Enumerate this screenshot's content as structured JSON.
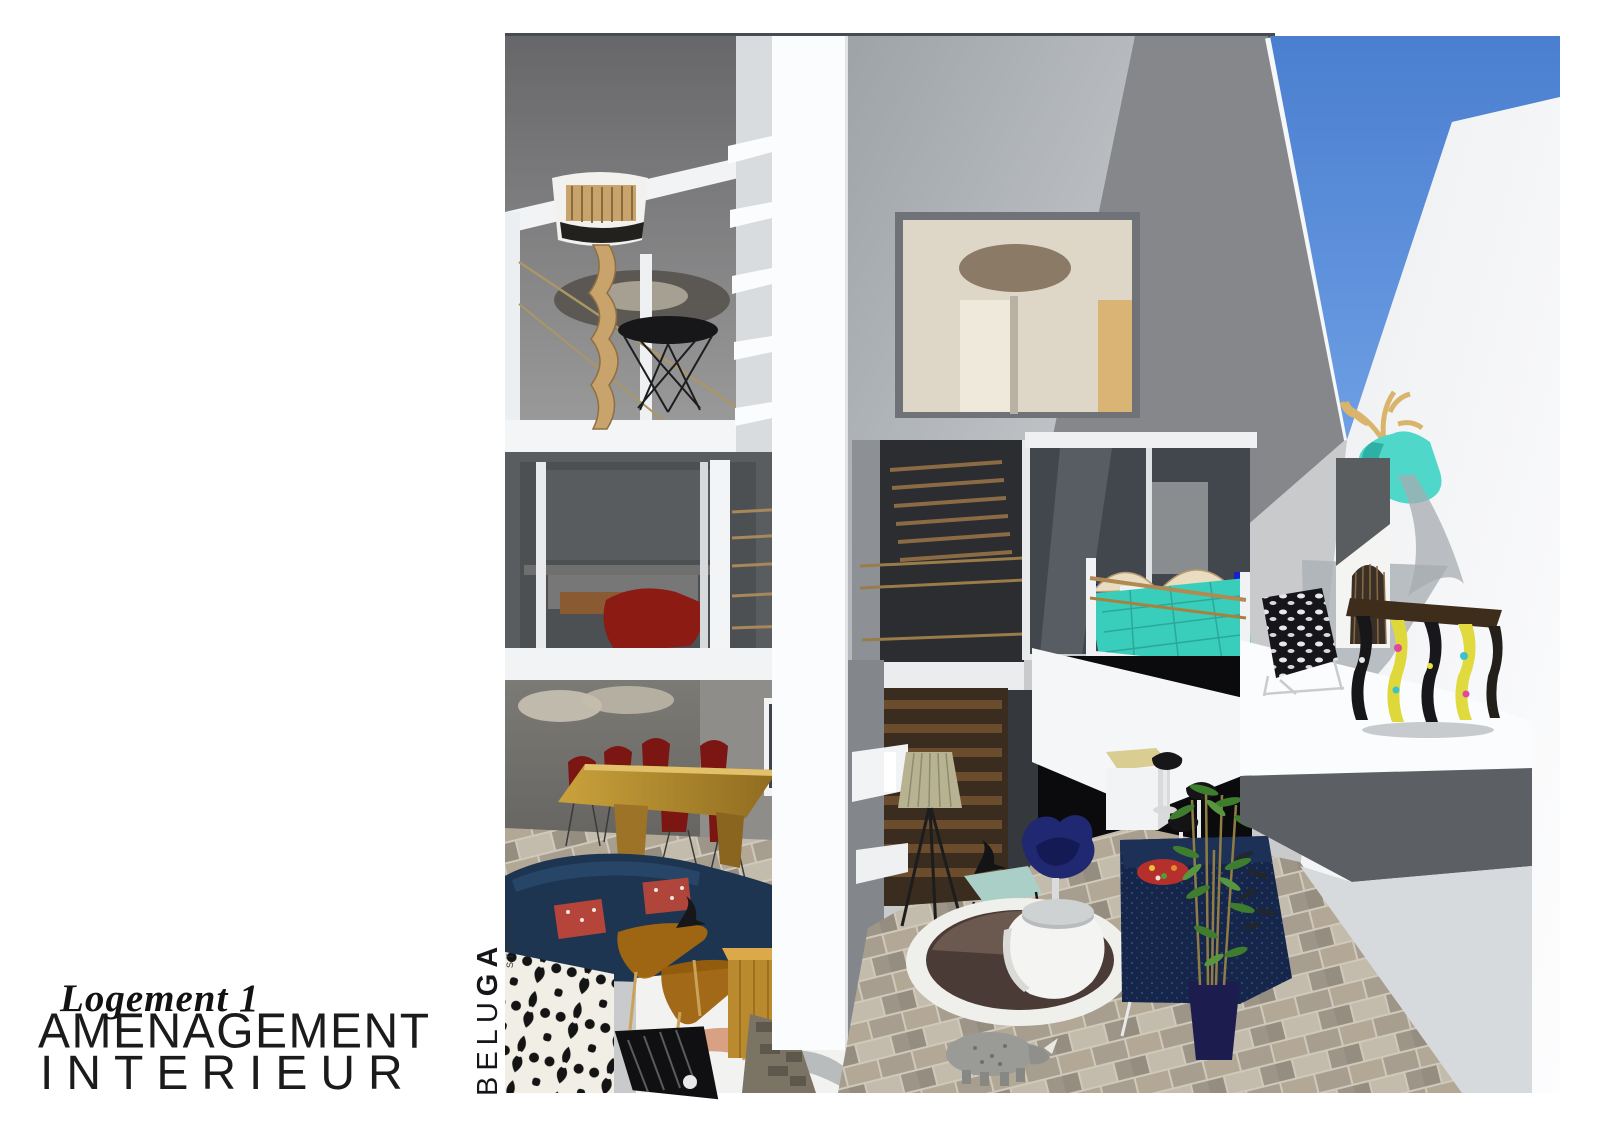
{
  "titles": {
    "project": "Logement 1",
    "subtitle_line1": "AMENAGEMENT",
    "subtitle_line2": "INTERIEUR"
  },
  "brand": {
    "name_light": "BELU",
    "name_bold": "GA",
    "tagline": "STUDIO"
  },
  "colors": {
    "sky": "#4e84d6",
    "roofGray": "#85878a",
    "ceilingGray": "#707071",
    "wallLight": "#c3c6c9",
    "wallWhite": "#f5f6f7",
    "glassDark": "#42474d",
    "stairWood": "#5b422c",
    "tableWood": "#b98a2e",
    "chairRed": "#8c1b13",
    "sofaNavy": "#1d3550",
    "benchNavy": "#16264a",
    "swanNavy": "#1f2870",
    "bedTeal": "#39cdbb",
    "deerTeal": "#4fd8ca",
    "antlerGold": "#d9b46a",
    "consoleYellow": "#ded83a",
    "bambooGreen": "#3f7d2e",
    "planterNavy": "#1c1d4e",
    "rugBrown": "#4b3b36",
    "amberGlass": "#a86a0e",
    "tvBlue": "#1316c9",
    "carYellow": "#c89a1a",
    "lampRope": "#c8a36b",
    "shadeBeige": "#b7b392",
    "rugDamaskInk": "#141414"
  },
  "scene": {
    "objects": [
      "rope-floor-lamp",
      "wire-side-table",
      "red-dining-chairs",
      "wood-dining-table",
      "navy-curved-sofa",
      "amber-glass-tables",
      "damask-rug",
      "wood-block-stool",
      "tripod-floor-lamp",
      "teal-side-table",
      "eames-bird",
      "swan-chair",
      "round-pot-table",
      "round-rug",
      "rhino-sculpture",
      "navy-bench-sofa",
      "bamboo-plant",
      "kitchen-island",
      "bar-stools",
      "yellow-car",
      "teal-bed",
      "wall-tv",
      "stairs",
      "deer-trophy",
      "birdcage",
      "baroque-console",
      "cowhide-chair",
      "sky",
      "tile-floor"
    ]
  }
}
